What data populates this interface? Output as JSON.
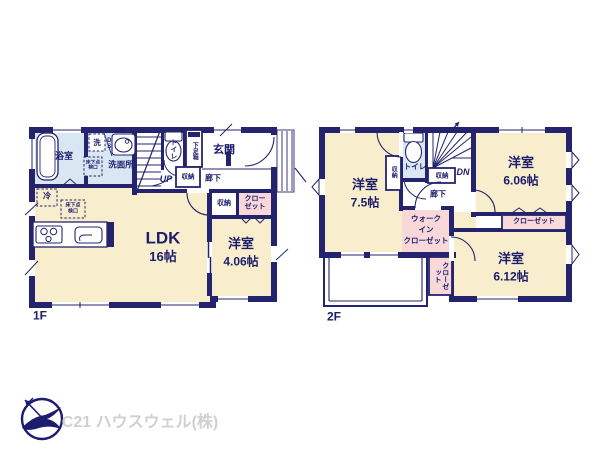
{
  "floor1": {
    "label": "1F",
    "bath": "浴室",
    "washer": "洗",
    "duct_space": "DS",
    "pipe_space": "PS",
    "washroom": "洗面所",
    "underfloor_hatch_wash": "床下点検口",
    "underfloor_hatch_ldk": "床下点検口",
    "fridge": "冷",
    "toilet": "トイレ",
    "shoe_box": "下足箱",
    "entrance": "玄関",
    "stairs_up": "UP",
    "storage_hall": "収納",
    "hallway": "廊下",
    "storage_south": "収納",
    "closet": "クローゼット",
    "ldk": "LDK",
    "ldk_size": "16帖",
    "bedroom": "洋室",
    "bedroom_size": "4.06帖"
  },
  "floor2": {
    "label": "2F",
    "bedroom1": "洋室",
    "bedroom1_size": "7.5帖",
    "storage_closet": "収納",
    "toilet": "トイレ",
    "stairs_dn": "DN",
    "storage_hall": "収納",
    "hallway": "廊下",
    "bedroom2": "洋室",
    "bedroom2_size": "6.06帖",
    "closet_north": "クローゼット",
    "wic_line1": "ウォーク",
    "wic_line2": "イン",
    "wic_line3": "クローゼット",
    "closet_side": "クローゼット",
    "bedroom3": "洋室",
    "bedroom3_size": "6.12帖"
  },
  "branding": {
    "company": "C21 ハウスウェル(株)"
  },
  "colors": {
    "wall_navy": "#24246e",
    "room_cream": "#f8eecd",
    "wet_area_blue": "#d9e7f3",
    "closet_pink": "#f8d8d8",
    "text_navy": "#1d1d6b",
    "logo_navy": "#1c1c70",
    "logo_text_gray": "#d0d0d0"
  }
}
